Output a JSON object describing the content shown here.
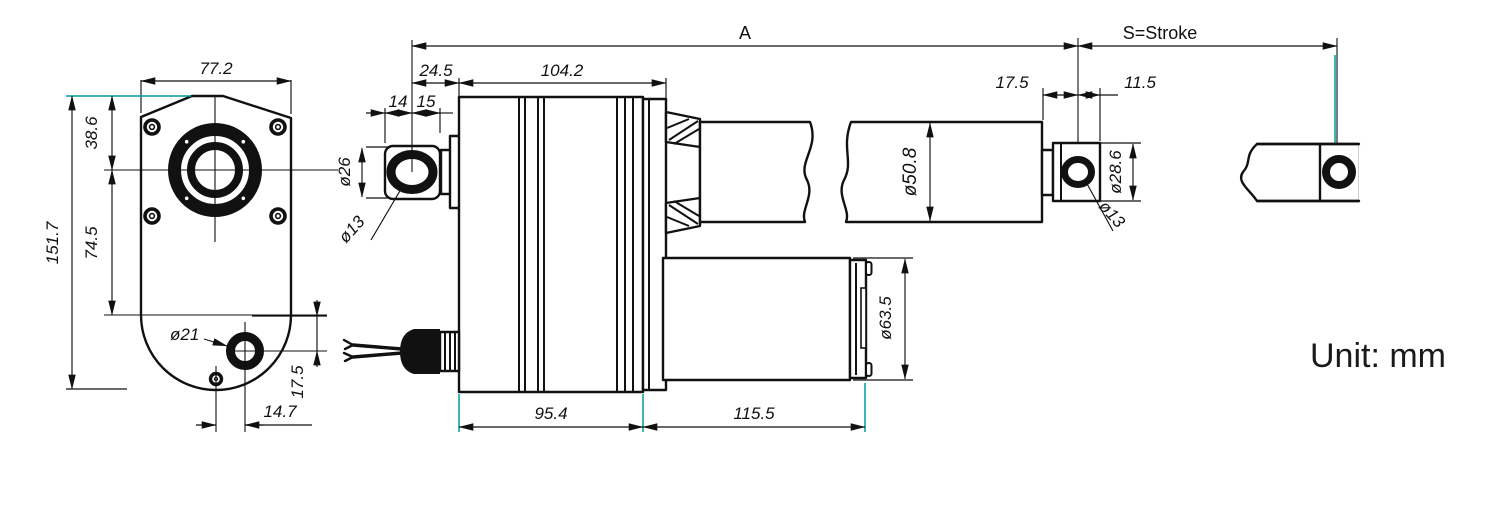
{
  "unit_label": "Unit: mm",
  "colors": {
    "line": "#111111",
    "accent_extension": "#009c9c"
  },
  "dims": {
    "overall": "A",
    "stroke": "S=Stroke",
    "front_width": "77.2",
    "front_height": "151.7",
    "front_center_from_top": "38.6",
    "front_center_to_bottom": "74.5",
    "front_lower_hole_dia": "ø21",
    "front_lower_hole_v": "17.5",
    "front_lower_hole_h": "14.7",
    "rear_pivot_to_body": "24.5",
    "housing_length": "104.2",
    "clevis_front": "14",
    "clevis_rear": "15",
    "clevis_od": "ø26",
    "clevis_hole_dia": "ø13",
    "outer_tube_dia": "ø50.8",
    "gearbox_length": "95.4",
    "motor_length": "115.5",
    "motor_dia": "ø63.5",
    "rod_shoulder_to_hole": "17.5",
    "rod_hole_to_tip": "11.5",
    "rod_end_od": "ø28.6",
    "rod_end_hole_dia": "ø13"
  }
}
